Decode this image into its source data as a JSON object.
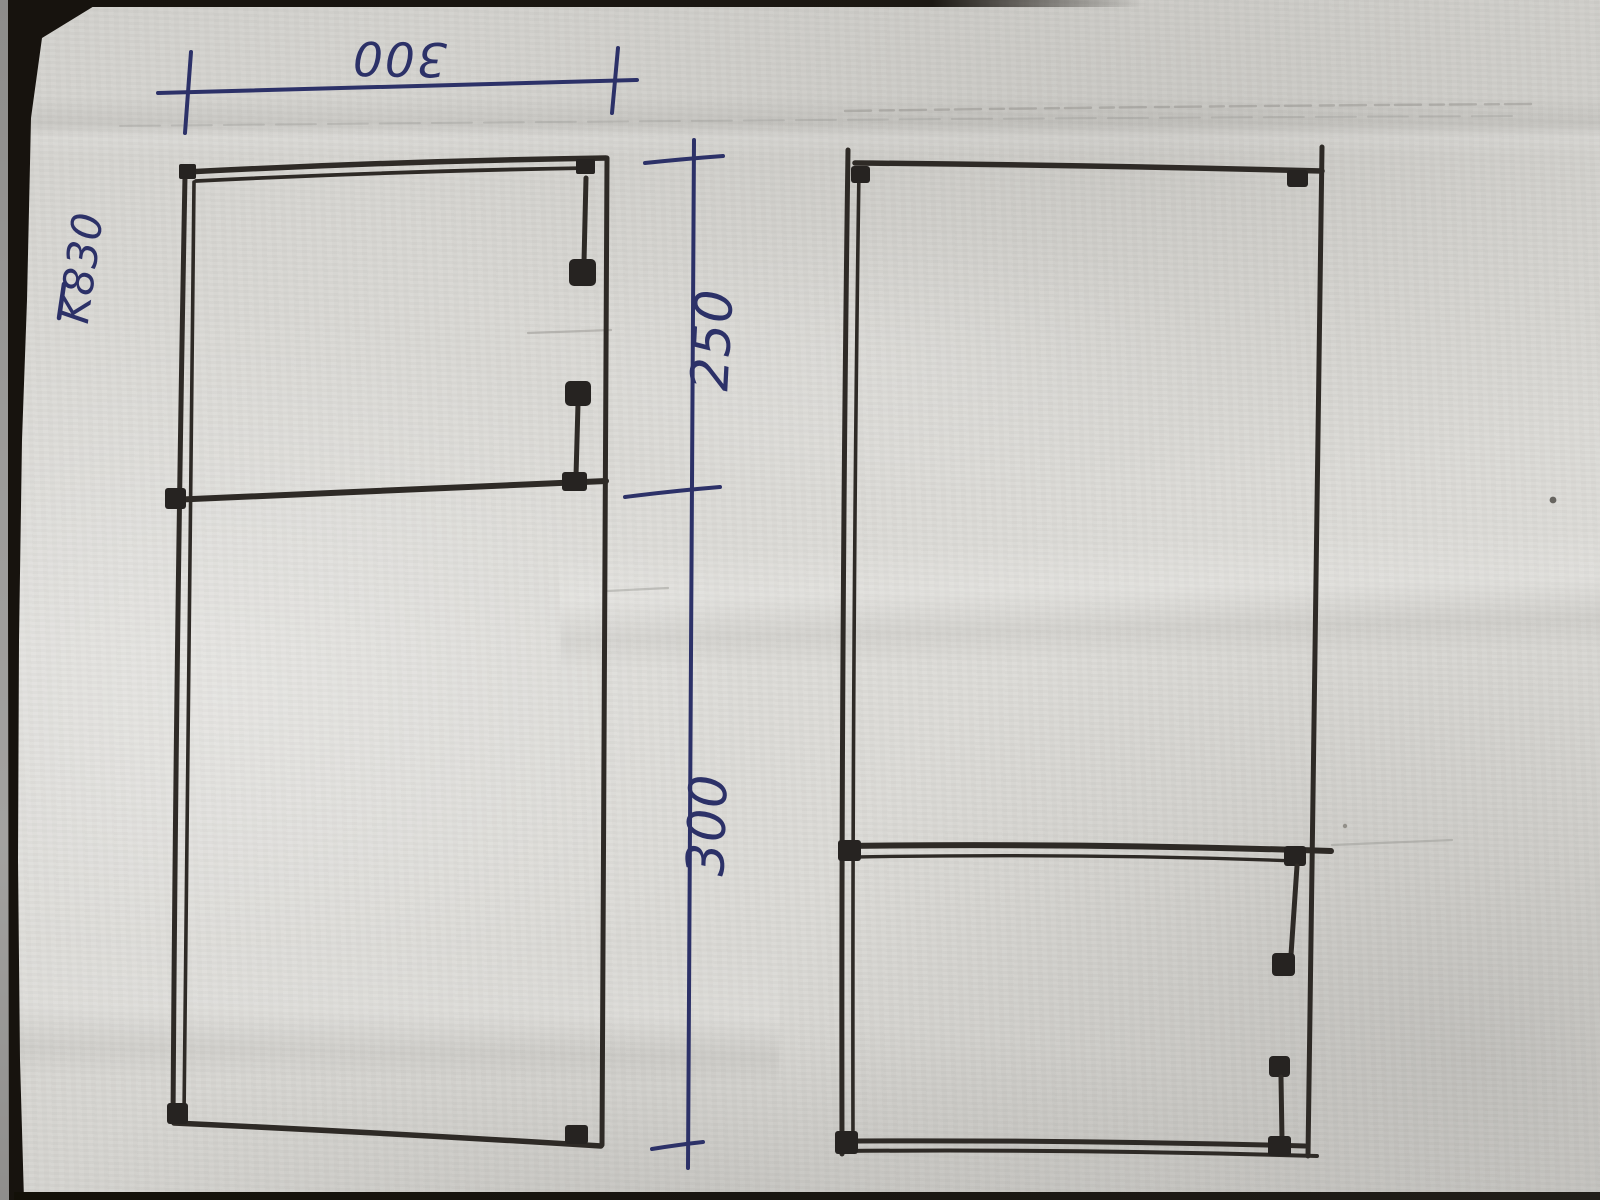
{
  "labels": {
    "part_code": "K830",
    "top_width_dim": "300",
    "upper_height_dim": "250",
    "lower_height_dim": "300"
  },
  "colors": {
    "paper": "#d9d8d4",
    "ink_blue": "#2c3168",
    "pencil_dark": "#2e2a26",
    "photo_edge_dark": "#17130e"
  },
  "drawing": {
    "description_left_panel": "tall rectangle split by divider, hinge hardware on right side",
    "description_right_panel": "tall rectangle with lower divider, hinge hardware on right side"
  }
}
